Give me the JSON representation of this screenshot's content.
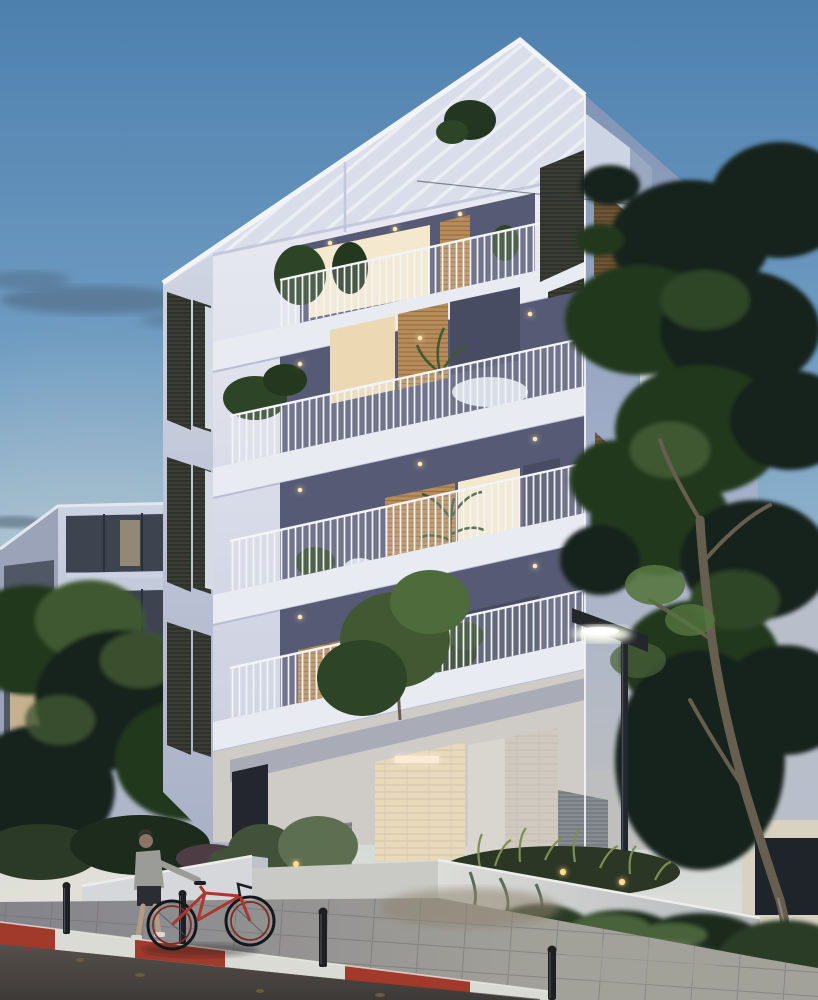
{
  "scene": {
    "description_tag": "dusk-apartment-building-rendering",
    "colors": {
      "sky_top": "#4e80ae",
      "sky_mid": "#6f9cc2",
      "sky_low": "#9dbbcf",
      "sky_horizon": "#c9d3d6",
      "sky_glow": "#e2e1d8",
      "cloud": "#44566a",
      "wire": "#2e3742",
      "nb_face_top": "#ccd3e2",
      "nb_face_bottom": "#a9b2c5",
      "nb_side": "#9aa3b8",
      "nb_band": "#3d4450",
      "nb_band_dark": "#39404c",
      "nb_lit1": "#d9c195",
      "nb_lit2": "#b89a6e",
      "nb_mullion": "#28303c",
      "nb_roofline": "#e2e6ee",
      "ff_top": "#eaebf3",
      "ff_bottom": "#c6cbdc",
      "lf_top": "#d0d5e3",
      "lf_bottom": "#a9b1c7",
      "rf_top": "#8295b7",
      "rf_mid": "#a9b4cc",
      "rf_bottom": "#bfc0bd",
      "roof_band": "#dadeea",
      "roof_edge": "#f2f4f8",
      "roof_step": "#c2c8da",
      "bulkhead": "#cdd4e4",
      "bulkhead_side": "#9aa7c0",
      "fascia": "#e9ebf3",
      "fascia_shade": "#b7bed3",
      "soffit_shade": "#8b90a8",
      "interior_dark": "#565a74",
      "interior_dark2": "#474c62",
      "glass_warm": "#ecd9b4",
      "glass_bright": "#f4e9cf",
      "glass_pale": "#d5dae4",
      "wood": "#b68c5a",
      "wood_line": "#97713f",
      "wood_dark": "#6e5636",
      "wood_dark_line": "#4f3d20",
      "shutter_dark": "#3a3d34",
      "shutter_line": "#262922",
      "louver_grey": "#878c92",
      "louver_line": "#6c7178",
      "downlight": "#ffe8b0",
      "rail_bar": "#f2f4f8",
      "rail_bg": "#eef1f6",
      "corner_light": "#f2f3f7",
      "ground_wall": "#cfccc8",
      "entry_warm": "#e8d9bb",
      "entry_glow": "#f9ecd2",
      "door_dark": "#23262e",
      "column": "#d9d5cf",
      "brick_white": "#cfc9c0",
      "brick_line": "#b9b2a6",
      "step": "#b8b9bb",
      "tree_dark": "#16241a",
      "tree_mid": "#24371f",
      "tree_mid2": "#2e4427",
      "tree_light": "#415833",
      "tree_lit": "#55763f",
      "trunk": "#665e4f",
      "trunk_light": "#8d8676",
      "small_tree": "#4e6b3b",
      "bush_light": "#5d6f50",
      "bush_mid": "#41513a",
      "bush_purple": "#4e3c44",
      "right_bldg": "#b9bfca",
      "right_bldg_lit": "#d8d2c2",
      "opening_dark": "#1f242b",
      "wallA": "#d6d7da",
      "wallA_side": "#bfc2c8",
      "wallB_top": "#dcddd9",
      "wallB_bot": "#b5b8bd",
      "wall_edge": "#ecedea",
      "path_light": "#c9cac6",
      "grass_dark": "#2c3624",
      "grass_blade": "#7c8e55",
      "hedge_dark": "#1c2b1c",
      "hedge_mid": "#2a3a26",
      "hedge_lit": "#48623a",
      "pave_left": "#84838a",
      "pave_right": "#a3a29a",
      "pave_joint": "#6a696d",
      "pave_warm": "#8f8370",
      "curb_red": "#a23a2c",
      "curb_white": "#dadbd5",
      "curb_shadow": "#3a3836",
      "curb_hl": "#e8e9e4",
      "road_top": "#564f4b",
      "road_bottom": "#3d3a38",
      "leaf": "#6b5a3c",
      "bollard": "#1e1f23",
      "bollard_hl": "#4a4e55",
      "lamp_dark": "#23262b",
      "lamp_glow": "#f8fae8",
      "lamp_core": "#ffffff",
      "skin": "#b59a84",
      "skin_face": "#8a7464",
      "jacket": "#9b9b97",
      "shorts": "#2c2d33",
      "hair": "#3b342c",
      "shoe": "#d8d8d4",
      "bike_red": "#a83830",
      "wheel": "#16171a",
      "rim_red": "#7e2c26",
      "seat": "#1d1e22",
      "shadow": "#1c1c1e",
      "pergola_plant": "#233621",
      "pergola_plant2": "#2d4427",
      "planter_glow": "#ffd98f"
    }
  }
}
